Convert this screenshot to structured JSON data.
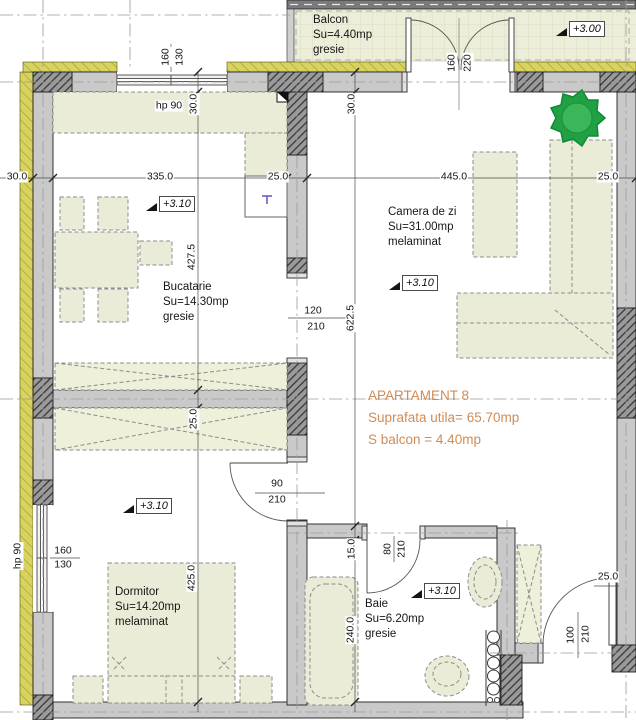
{
  "title_block": {
    "apartment": "APARTAMENT 8",
    "usable_area": "Suprafata utila= 65.70mp",
    "balcony_area": "S balcon = 4.40mp"
  },
  "rooms": {
    "balcon": {
      "name": "Balcon",
      "area": "Su=4.40mp",
      "finish": "gresie"
    },
    "bucatarie": {
      "name": "Bucatarie",
      "area": "Su=14.30mp",
      "finish": "gresie"
    },
    "camera_de_zi": {
      "name": "Camera de zi",
      "area": "Su=31.00mp",
      "finish": "melaminat"
    },
    "dormitor": {
      "name": "Dormitor",
      "area": "Su=14.20mp",
      "finish": "melaminat"
    },
    "baie": {
      "name": "Baie",
      "area": "Su=6.20mp",
      "finish": "gresie"
    }
  },
  "elevations": {
    "balcony": "+3.00",
    "kitchen": "+3.10",
    "living": "+3.10",
    "bedroom": "+3.10",
    "bathroom": "+3.10"
  },
  "dims_top": {
    "wall_left": "30.0",
    "kitchen_width": "335.0",
    "wall_mid": "25.0",
    "living_width": "445.0",
    "wall_right": "25.0"
  },
  "dims_left_chain": {
    "wall": "30.0",
    "kitchen_depth": "427.5",
    "closet_wall": "25.0",
    "bedroom_depth": "425.0"
  },
  "dims_mid_chain": {
    "wall": "30.0",
    "living_depth": "622.5",
    "wall_jog": "15.0",
    "bath_depth": "240.0"
  },
  "dims_other": {
    "entry_wall": "25.0"
  },
  "windows": {
    "kitchen": {
      "width": "160",
      "height": "130",
      "parapet": "hp 90"
    },
    "bedroom": {
      "width": "160",
      "height": "130",
      "parapet": "hp 90"
    }
  },
  "doors": {
    "balcony": {
      "width": "160",
      "height": "220"
    },
    "kitchen_living": {
      "width": "120",
      "height": "210"
    },
    "bedroom": {
      "width": "90",
      "height": "210"
    },
    "bathroom": {
      "width": "80",
      "height": "210"
    },
    "entrance": {
      "width": "100",
      "height": "210"
    }
  },
  "colors": {
    "accent_text": "#d08c55",
    "wall_fill": "#c9c9c9",
    "insulation": "#d8d25f",
    "room_fill": "#ebecd8",
    "tree_green": "#22a045",
    "balcony_floor": "#edeeda"
  }
}
